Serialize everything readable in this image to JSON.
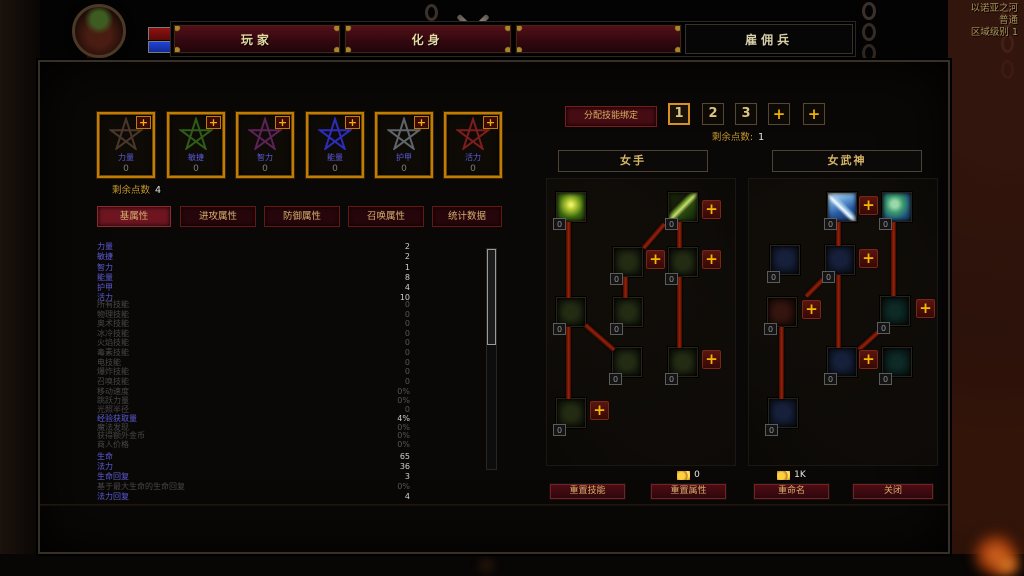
{
  "hud": {
    "level": "1",
    "health": "65 / 65",
    "mana": "36 / 36"
  },
  "region": {
    "name": "以诺亚之河",
    "difficulty": "普通",
    "area_level": "区域级别 1"
  },
  "top_tabs": [
    {
      "label": "玩家"
    },
    {
      "label": "化身"
    },
    {
      "label": ""
    },
    {
      "label": "雇佣兵"
    }
  ],
  "attributes": {
    "cards": [
      {
        "name": "力量",
        "value": "0",
        "color": "#4a372a"
      },
      {
        "name": "敏捷",
        "value": "0",
        "color": "#2f5c18"
      },
      {
        "name": "智力",
        "value": "0",
        "color": "#5c2357"
      },
      {
        "name": "能量",
        "value": "0",
        "color": "#2d2dbd"
      },
      {
        "name": "护甲",
        "value": "0",
        "color": "#5f656b"
      },
      {
        "name": "活力",
        "value": "0",
        "color": "#7d1d1d"
      }
    ],
    "remaining_label": "剩余点数",
    "remaining_value": "4"
  },
  "stat_tabs": [
    {
      "label": "基属性"
    },
    {
      "label": "进攻属性"
    },
    {
      "label": "防御属性"
    },
    {
      "label": "召唤属性"
    },
    {
      "label": "统计数据"
    }
  ],
  "stats": [
    {
      "label": "力量",
      "value": "2"
    },
    {
      "label": "敏捷",
      "value": "2"
    },
    {
      "label": "智力",
      "value": "1"
    },
    {
      "label": "能量",
      "value": "8"
    },
    {
      "label": "护甲",
      "value": "4"
    },
    {
      "label": "活力",
      "value": "10"
    },
    {
      "label": "所有技能",
      "value": "0"
    },
    {
      "label": "物理技能",
      "value": "0"
    },
    {
      "label": "奥术技能",
      "value": "0"
    },
    {
      "label": "冰冷技能",
      "value": "0"
    },
    {
      "label": "火焰技能",
      "value": "0"
    },
    {
      "label": "毒素技能",
      "value": "0"
    },
    {
      "label": "电技能",
      "value": "0"
    },
    {
      "label": "爆炸技能",
      "value": "0"
    },
    {
      "label": "召唤技能",
      "value": "0"
    },
    {
      "label": "移动速度",
      "value": "0%"
    },
    {
      "label": "跳跃力量",
      "value": "0%"
    },
    {
      "label": "光照半径",
      "value": "0"
    },
    {
      "label": "经验获取量",
      "value": "4%"
    },
    {
      "label": "魔法发现",
      "value": "0%"
    },
    {
      "label": "获得额外金币",
      "value": "0%"
    },
    {
      "label": "商人价格",
      "value": "0%"
    },
    {
      "label": "生命",
      "value": "65"
    },
    {
      "label": "法力",
      "value": "36"
    },
    {
      "label": "生命回复",
      "value": "3"
    },
    {
      "label": "基于最大生命的生命回复",
      "value": "0%"
    },
    {
      "label": "法力回复",
      "value": "4"
    }
  ],
  "skills": {
    "assign_binding_button": "分配技能绑定",
    "slot_tabs": [
      "1",
      "2",
      "3"
    ],
    "remaining_label": "剩余点数:",
    "remaining_value": "1",
    "trees": [
      {
        "title": "女手",
        "nodes": [
          {
            "icon": "poison-skull",
            "count": "0"
          },
          {
            "icon": "green-spear",
            "count": "0"
          },
          {
            "icon": "bow-shot",
            "count": "0"
          },
          {
            "icon": "spear-strike",
            "count": "0"
          },
          {
            "icon": "trap",
            "count": "0"
          },
          {
            "icon": "multi-shot",
            "count": "0"
          },
          {
            "icon": "bomb",
            "count": "0"
          },
          {
            "icon": "spike-field",
            "count": "0"
          },
          {
            "icon": "skull-swarm",
            "count": "0"
          }
        ]
      },
      {
        "title": "女武神",
        "nodes": [
          {
            "icon": "storm-javelin",
            "count": "0"
          },
          {
            "icon": "valkyrie",
            "count": "0"
          },
          {
            "icon": "war-cry",
            "count": "0"
          },
          {
            "icon": "lightning-strike",
            "count": "0"
          },
          {
            "icon": "shred-claws",
            "count": "0"
          },
          {
            "icon": "whirl-strike",
            "count": "0"
          },
          {
            "icon": "dive-attack",
            "count": "0"
          },
          {
            "icon": "leap",
            "count": "0"
          },
          {
            "icon": "hydra",
            "count": "0"
          }
        ]
      }
    ]
  },
  "footer": {
    "reset_skills": "重置技能",
    "reset_stats": "重置属性",
    "reset_stats_cost": "0",
    "rename": "重命名",
    "rename_cost": "1K",
    "close": "关闭"
  },
  "glyphs": {
    "plus": "+"
  }
}
